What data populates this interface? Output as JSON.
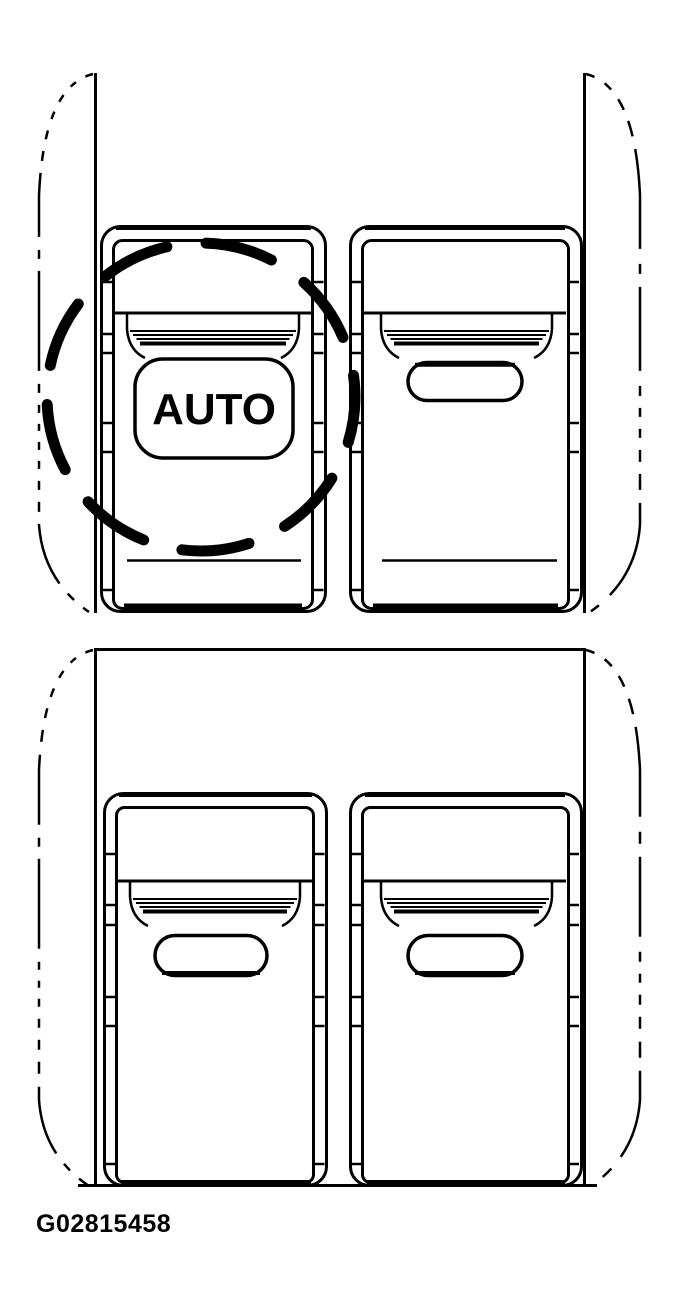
{
  "figure": {
    "id": "G02815458",
    "auto_label": "AUTO"
  },
  "colors": {
    "line": "#000000",
    "background": "#ffffff"
  },
  "icons": {
    "highlight_circle": "dashed-circle-callout"
  }
}
